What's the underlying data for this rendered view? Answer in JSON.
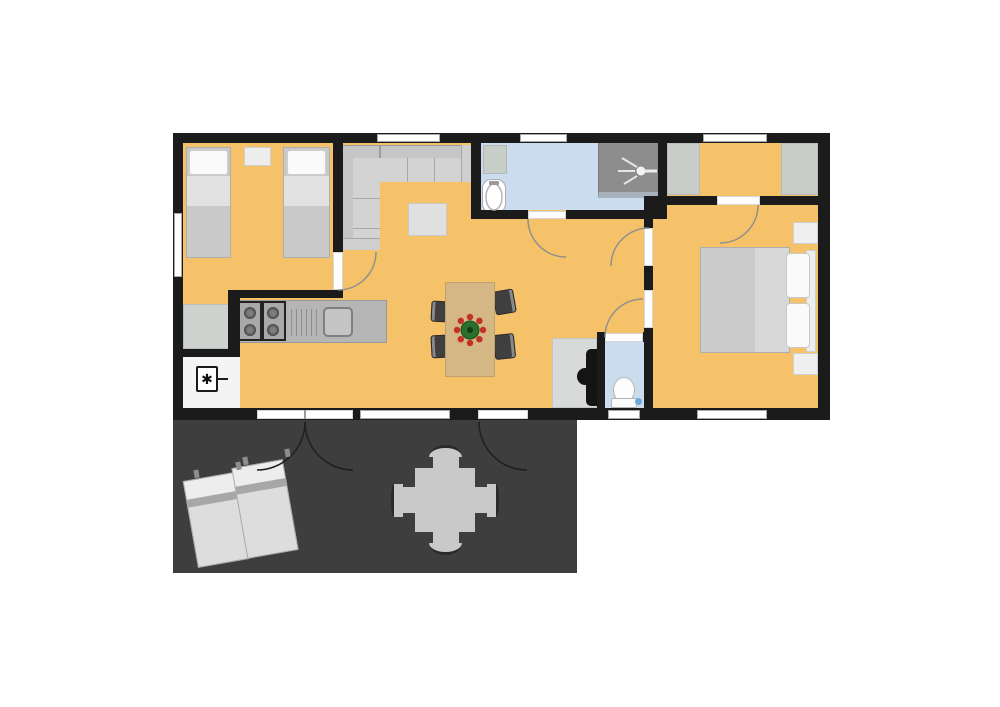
{
  "title": "Cabin floor plan with terrace",
  "symbols": {
    "electrical_panel": "✱"
  },
  "palette": {
    "wall": "#1b1b1b",
    "floor_wood": "#f5c169",
    "wet_room_floor": "#cbdcef",
    "deck": "#3e3e3e",
    "furniture_gray": "#c8c8c8",
    "wardrobe_gray": "#cdd2ce",
    "table_wood": "#d5b786",
    "chair_dark": "#3f3f3f",
    "shower_gray": "#8d8d8d",
    "plant_green": "#2c6e2b",
    "plant_red": "#c33026",
    "white": "#ffffff"
  },
  "rooms": [
    {
      "id": "bedroom-1",
      "label": "Bedroom 1 — two single beds, nightstand, wardrobe"
    },
    {
      "id": "living-kitchen",
      "label": "Open living room and kitchen — corner sofa, coffee table, dining table with four chairs, kitchen counter with hob and sink, wood stove, electrical panel"
    },
    {
      "id": "bathroom",
      "label": "Bathroom — washbasin, bathtub, shower"
    },
    {
      "id": "wc",
      "label": "WC — toilet"
    },
    {
      "id": "closet",
      "label": "Dressing area — two wardrobes"
    },
    {
      "id": "bedroom-2",
      "label": "Bedroom 2 — double bed, headboard, two nightstands"
    },
    {
      "id": "deck",
      "label": "Terrace — two sun loungers, outdoor table with four chairs"
    }
  ],
  "openings": {
    "windows": 7,
    "exterior_door_sets": 2,
    "interior_doors": 5
  }
}
